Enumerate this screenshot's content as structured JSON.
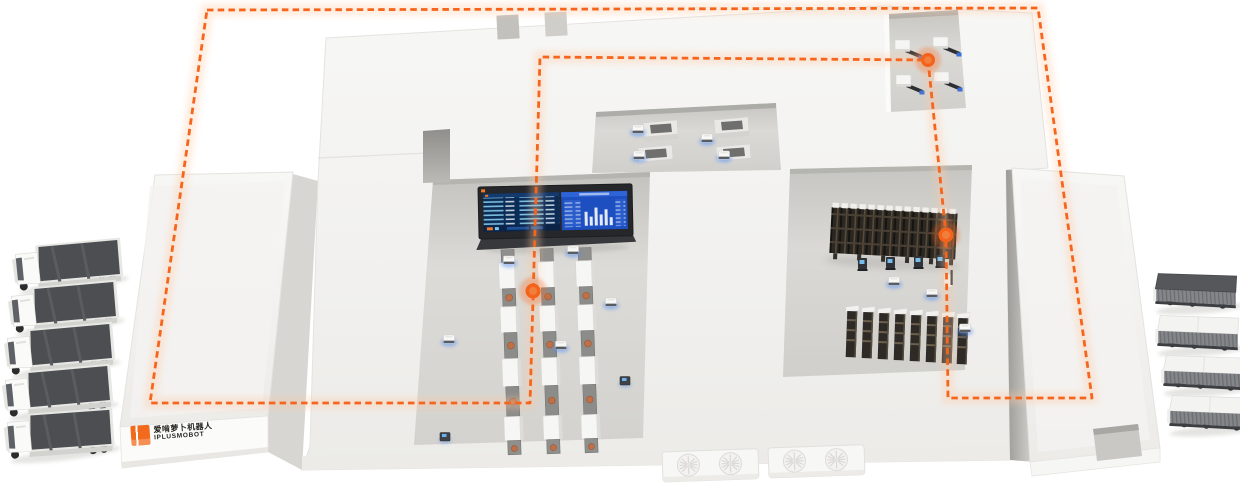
{
  "logo": {
    "line1": "爱啃萝卜机器人",
    "line2": "IPLUSMOBOT"
  },
  "palette": {
    "accent_orange": "#f5651d",
    "agv_glow_blue": "#4f8df7",
    "screen_navy": "#0c2c58",
    "screen_blue": "#1d4fc0",
    "building_white": "#f4f4f2",
    "floor_gray": "#d6d5d1",
    "rack_dark": "#2b2722",
    "truck_top_gray": "#4c4e51"
  },
  "scene": {
    "left_truck_count": 5,
    "right_truck_count": 4,
    "production_line_count": 3,
    "workstation_count": 4,
    "cnc_machine_count": 4,
    "storage_rack_column_count": 8,
    "route_waypoint_count": 3,
    "agv_count": 10
  }
}
